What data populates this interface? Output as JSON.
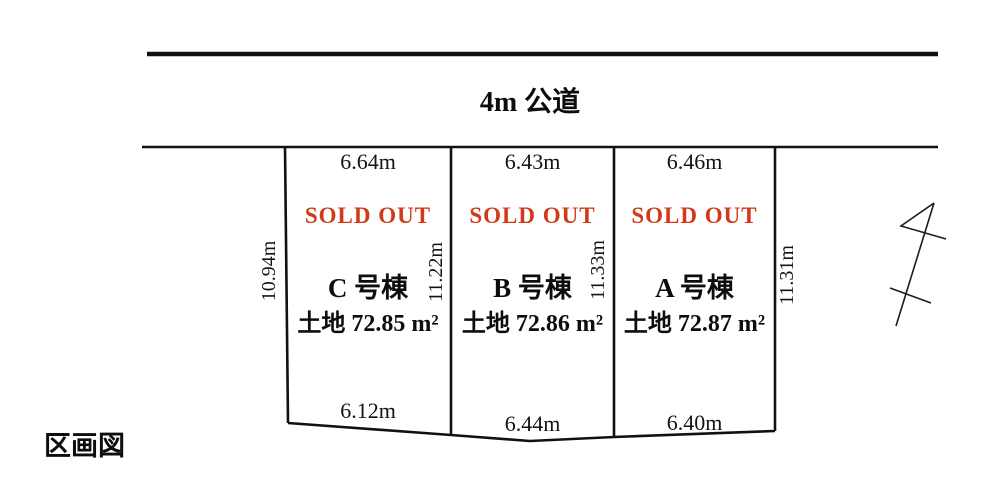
{
  "title": "区画図",
  "road": {
    "label": "4m 公道"
  },
  "plots": [
    {
      "id": "C",
      "name": "C 号棟",
      "status": "SOLD OUT",
      "area": "土地 72.85 m²",
      "top_dim": "6.64m",
      "bottom_dim": "6.12m"
    },
    {
      "id": "B",
      "name": "B 号棟",
      "status": "SOLD OUT",
      "area": "土地 72.86 m²",
      "top_dim": "6.43m",
      "bottom_dim": "6.44m"
    },
    {
      "id": "A",
      "name": "A 号棟",
      "status": "SOLD OUT",
      "area": "土地 72.87 m²",
      "top_dim": "6.46m",
      "bottom_dim": "6.40m"
    }
  ],
  "side_dims": {
    "left": "10.94m",
    "between_c_b": "11.22m",
    "between_b_a": "11.33m",
    "right": "11.31m"
  },
  "icons": {
    "north_arrow": "north-arrow-icon"
  },
  "colors": {
    "sold_out_red": "#d03a18",
    "line_black": "#111111"
  }
}
